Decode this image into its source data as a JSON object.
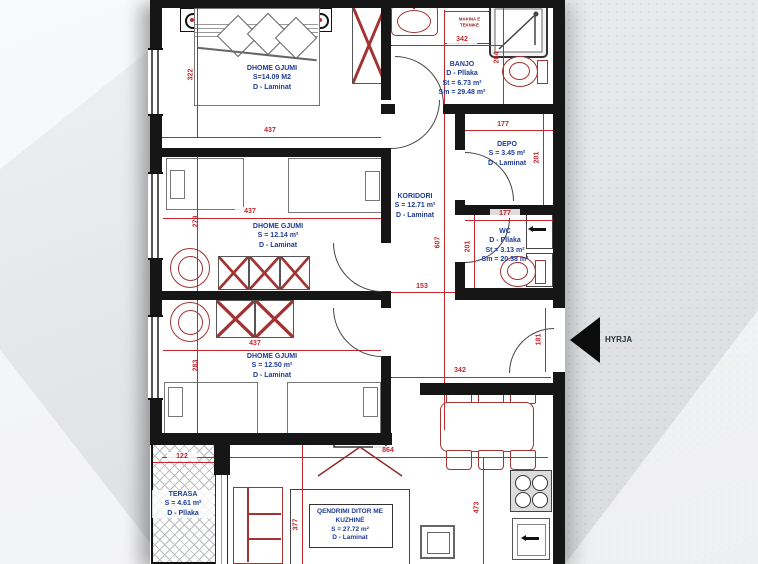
{
  "plan": {
    "rooms": [
      {
        "id": "bedroom-1",
        "lines": [
          "DHOME GJUMI",
          "S=14.09 M2",
          "D - Laminat"
        ]
      },
      {
        "id": "bathroom",
        "lines": [
          "BANJO",
          "D - Pllaka",
          "St = 6.73 m²",
          "Sm = 29.48 m²"
        ]
      },
      {
        "id": "storage",
        "lines": [
          "DEPO",
          "S = 3.45 m²",
          "D - Laminat"
        ]
      },
      {
        "id": "corridor",
        "lines": [
          "KORIDORI",
          "S = 12.71 m²",
          "D - Laminat"
        ]
      },
      {
        "id": "wc",
        "lines": [
          "WC",
          "D - Pllaka",
          "St = 3.13 m²",
          "Sm = 20.38 m²"
        ]
      },
      {
        "id": "bedroom-2",
        "lines": [
          "DHOME GJUMI",
          "S = 12.14 m²",
          "D - Laminat"
        ]
      },
      {
        "id": "bedroom-3",
        "lines": [
          "DHOME GJUMI",
          "S = 12.50 m²",
          "D - Laminat"
        ]
      },
      {
        "id": "terrace",
        "lines": [
          "TERASA",
          "S = 4.61 m²",
          "D - Pllaka"
        ]
      },
      {
        "id": "living-kitchen",
        "lines": [
          "QENDRIMI DITOR ME",
          "KUZHINË",
          "S = 27.72 m²",
          "D - Laminat"
        ]
      }
    ],
    "entrance_label": "HYRJA",
    "washing_machine_label": [
      "MAKINA E",
      "TEKNIKE"
    ],
    "dimensions": {
      "bedroom1_width": "437",
      "bedroom1_height": "322",
      "bedroom2_width": "437",
      "bedroom2_height": "279",
      "bedroom3_width": "437",
      "bedroom3_height": "283",
      "bathroom_width": "342",
      "bathroom_height": "204",
      "storage_width": "177",
      "storage_height": "201",
      "wc_width": "177",
      "wc_height": "201",
      "corridor_length": "607",
      "corridor_width": "153",
      "hall_width": "342",
      "hall_height": "181",
      "living_width": "864",
      "living_height": "473",
      "living_side_height": "377",
      "terrace_width": "122"
    },
    "colors": {
      "wall": "#161616",
      "dimension": "#c1272d",
      "room_label": "#1e3c96",
      "furniture_red": "#a23333"
    }
  }
}
